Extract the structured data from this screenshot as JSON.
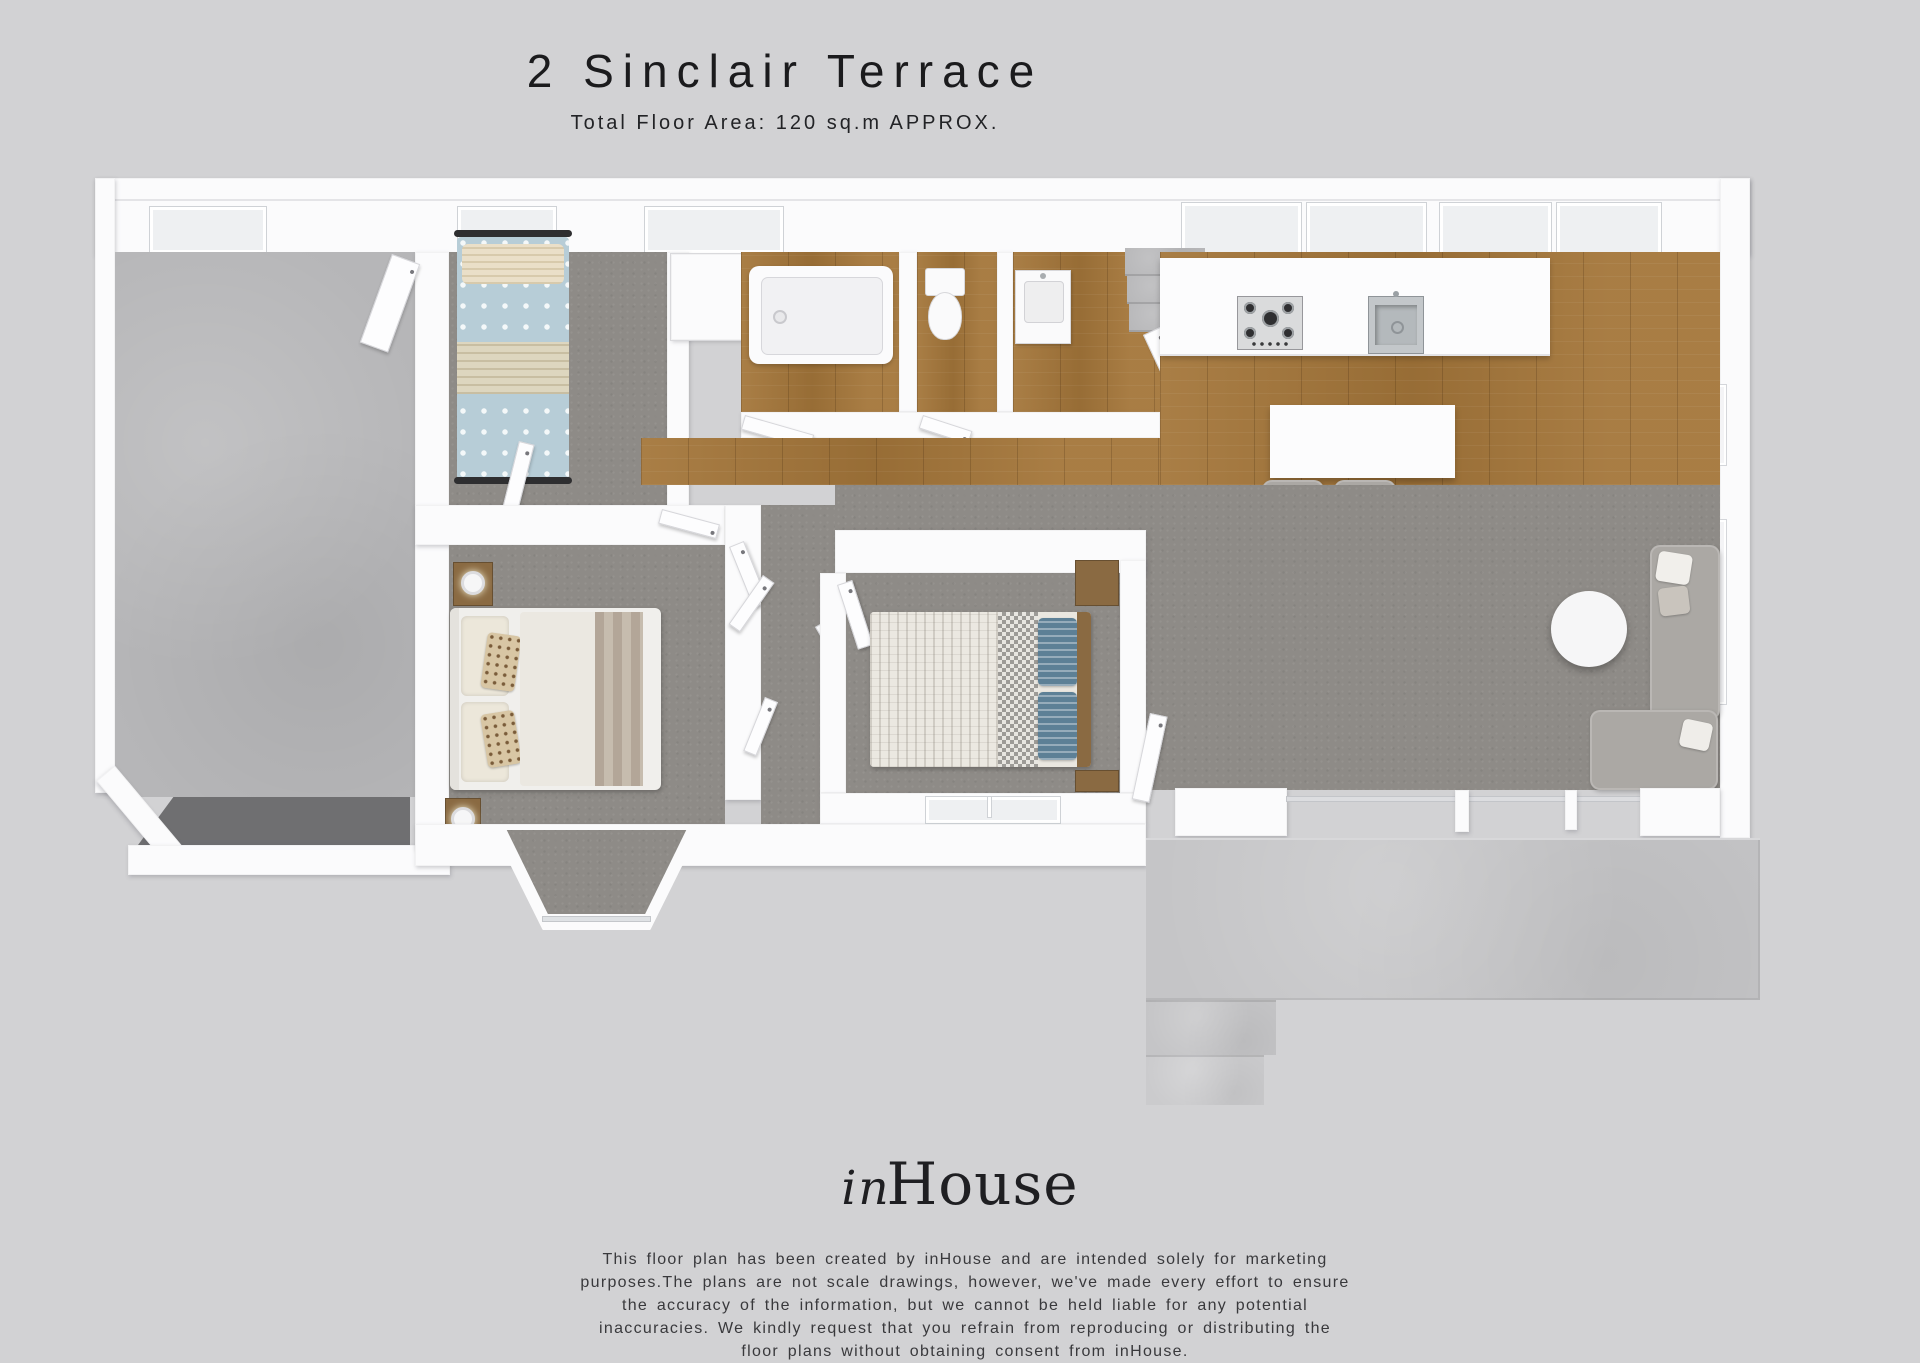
{
  "header": {
    "title": "2 Sinclair Terrace",
    "subtitle": "Total Floor Area: 120 sq.m APPROX."
  },
  "footer": {
    "logo_script": "in",
    "logo_serif": "House",
    "disclaimer_lines": [
      "This floor plan has been created by inHouse and are intended solely for marketing",
      "purposes.The plans are not scale drawings, however, we've made every effort to ensure",
      "the accuracy of the information, but we cannot be held liable for any potential",
      "inaccuracies. We kindly request that you refrain from reproducing or distributing the",
      "floor plans without obtaining consent from inHouse."
    ]
  },
  "palette": {
    "bg": "#d2d2d4",
    "wall": "#fbfbfc",
    "carpet": "#8e8b87",
    "wood": "#a4763a",
    "concrete": "#b6b6b8",
    "patio": "#c5c5c7",
    "garage_door": "#6f6f71",
    "steel": "#c3c7ca",
    "bed_blue": "#b7cdd7",
    "pillow_cream": "#eadfc8",
    "throw_cream": "#ddd6bf",
    "duvet_white": "#ebe8e1",
    "runner_taupe": "#b3a698",
    "hound_gray": "#9d9b97",
    "pillow_blue": "#5d8096",
    "sofa": "#aba8a4",
    "wood_furn": "#8a6a42",
    "text_dark": "#1b1b1d"
  }
}
